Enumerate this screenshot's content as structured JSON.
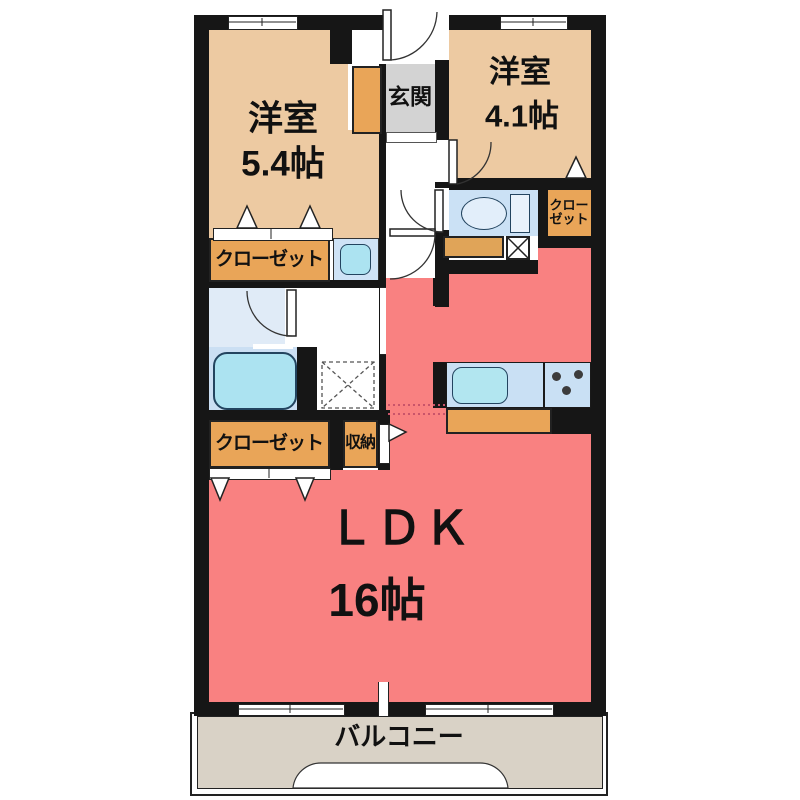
{
  "floorplan": {
    "bedroom1": {
      "name": "洋室",
      "size": "5.4帖"
    },
    "bedroom2": {
      "name": "洋室",
      "size": "4.1帖"
    },
    "entrance": {
      "label": "玄関"
    },
    "closet_top": {
      "label": "クローゼット"
    },
    "closet_right": {
      "line1": "クロー",
      "line2": "ゼット"
    },
    "closet_bottom": {
      "label": "クローゼット"
    },
    "storage": {
      "label": "収納"
    },
    "ldk": {
      "name": "ＬＤＫ",
      "size": "16帖"
    },
    "balcony": {
      "label": "バルコニー"
    }
  },
  "colors": {
    "wall": "#161616",
    "bedroom_tan": "#edcaa2",
    "closet_orange": "#e9a558",
    "ldk_pink": "#f98181",
    "entrance_gray": "#d3d3d3",
    "balcony_beige": "#d9d2c6",
    "washroom_blue": "#e0ebf7",
    "bath_blue": "#cbdff3",
    "toilet_floor_blue": "#cbe1f5",
    "kitchen_counter_blue": "#c9e0f4",
    "fixture_cyan": "#ace3f1"
  },
  "fixtures": [
    "toilet",
    "bathtub",
    "wash-basin",
    "kitchen-sink",
    "stove",
    "washing-machine-space",
    "pipe-space"
  ]
}
